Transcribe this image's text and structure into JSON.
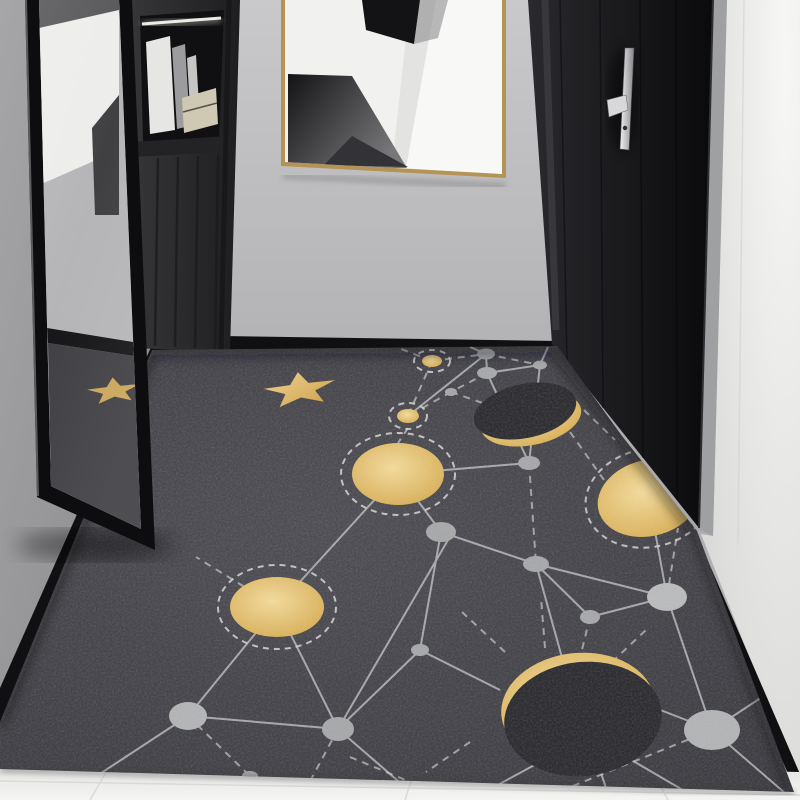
{
  "scene": {
    "kind": "interior-photograph",
    "subject": "Entryway hallway with dark celestial constellation rug",
    "no_visible_text": true
  },
  "colors": {
    "wall_center_top": "#c9c9cb",
    "wall_center_bottom": "#a7a7a9",
    "wall_left_top": "#a6a6a8",
    "wall_left_bottom": "#8a8a8c",
    "wall_right_top": "#f7f7f5",
    "wall_right_bottom": "#d7d7d5",
    "baseboard": "#101012",
    "cabinet_left": "#37373a",
    "cabinet_right": "#1e1e20",
    "niche_interior": "#101012",
    "shelf_light": "#f2f2e6",
    "book_white": "#e6e6e4",
    "book_gray": "#9c9c9e",
    "book_tan": "#cfc8b2",
    "art_frame_gold": "#b39356",
    "canvas_white": "#f1f1ef",
    "art_black": "#131315",
    "art_gray": "#77777a",
    "door_left": "#2a2a2e",
    "door_right": "#0a0a0c",
    "door_frame": "#9fa0a2",
    "handle_light": "#f0f0f2",
    "handle_dark": "#86868a",
    "rug_light": "#4e4e54",
    "rug_dark": "#3a3a3f",
    "rug_disk_dark": "#2d2d31",
    "gold_hi": "#f2da9b",
    "gold_lo": "#d3a74b",
    "gold_star_hi": "#ecd08e",
    "gold_star_lo": "#cfa045",
    "gold_reflection": "#c9a254",
    "node_gray": "#a6a7a9",
    "line_gray": "#bfc0c2",
    "mirror_frame": "#0d0d0f",
    "mirror_wall_reflection": "#b3b3b5",
    "mirror_rug_reflection": "#3b3b3f",
    "marble_light": "#f4f4f2",
    "marble_dark": "#dfdfdd"
  },
  "objects": {
    "mirror": "full-length leaning mirror, black frame, reflects wall, baseboard and rug star",
    "cabinet": "dark charcoal entry cabinet with open lit shelf holding books, slatted lower panel",
    "artwork": "gold-framed abstract black / white geometric print on center wall",
    "door": "black entry door with vertical silver lever handle, white frame at right",
    "rug": "dark gray mat with gold star, gold planets in dashed orbit rings, two eclipsed moons with gold crescents, gray constellation nodes joined by solid and dashed lines",
    "floor": "white marble tile strip at bottom edge"
  }
}
